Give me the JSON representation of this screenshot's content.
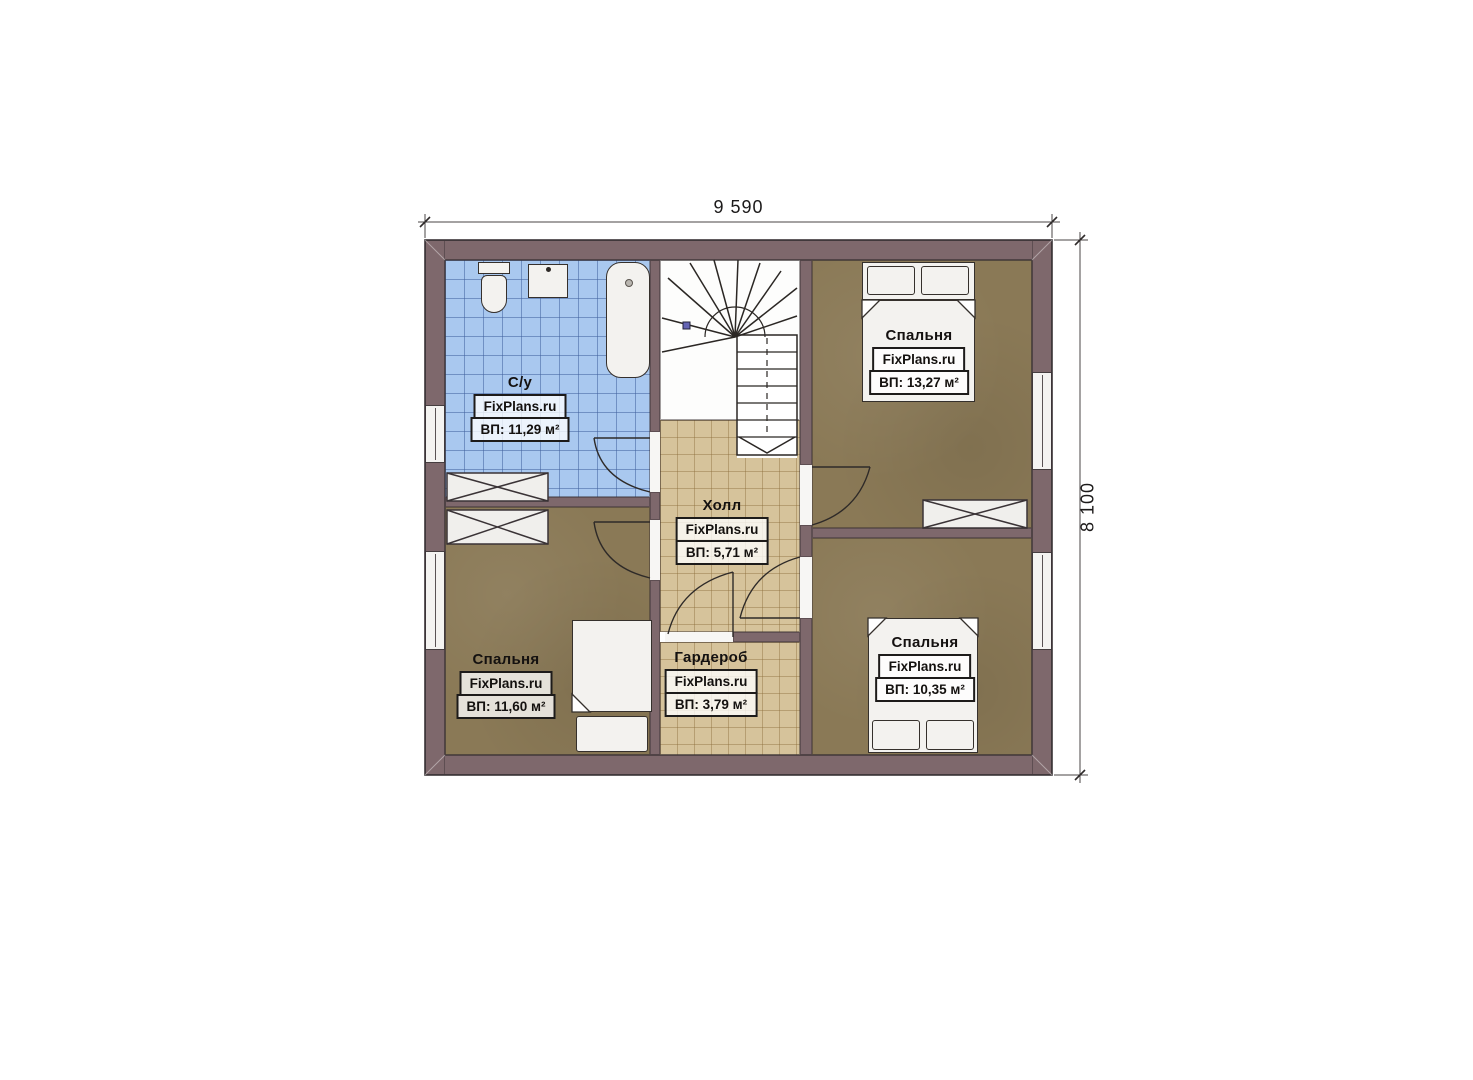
{
  "plan": {
    "title": "floor-plan-second-storey",
    "dimensions": {
      "width": "9 590",
      "height": "8 100"
    },
    "rooms": [
      {
        "key": "bathroom",
        "name": "С/у",
        "watermark": "FixPlans.ru",
        "area": "ВП: 11,29 м²"
      },
      {
        "key": "hall",
        "name": "Холл",
        "watermark": "FixPlans.ru",
        "area": "ВП: 5,71 м²"
      },
      {
        "key": "bedroom_top_right",
        "name": "Спальня",
        "watermark": "FixPlans.ru",
        "area": "ВП: 13,27 м²"
      },
      {
        "key": "bedroom_bottom_left",
        "name": "Спальня",
        "watermark": "FixPlans.ru",
        "area": "ВП: 11,60 м²"
      },
      {
        "key": "wardrobe",
        "name": "Гардероб",
        "watermark": "FixPlans.ru",
        "area": "ВП: 3,79 м²"
      },
      {
        "key": "bedroom_bottom_right",
        "name": "Спальня",
        "watermark": "FixPlans.ru",
        "area": "ВП: 10,35 м²"
      }
    ],
    "colors": {
      "wall": "#7e686c",
      "bathroom_tile": "#a9c8ef",
      "hall_tile": "#d6c39b",
      "bedroom_floor": "#8a7956",
      "fixture_white": "#f3f2ef",
      "stair_marker_blue": "#6464b4"
    }
  }
}
